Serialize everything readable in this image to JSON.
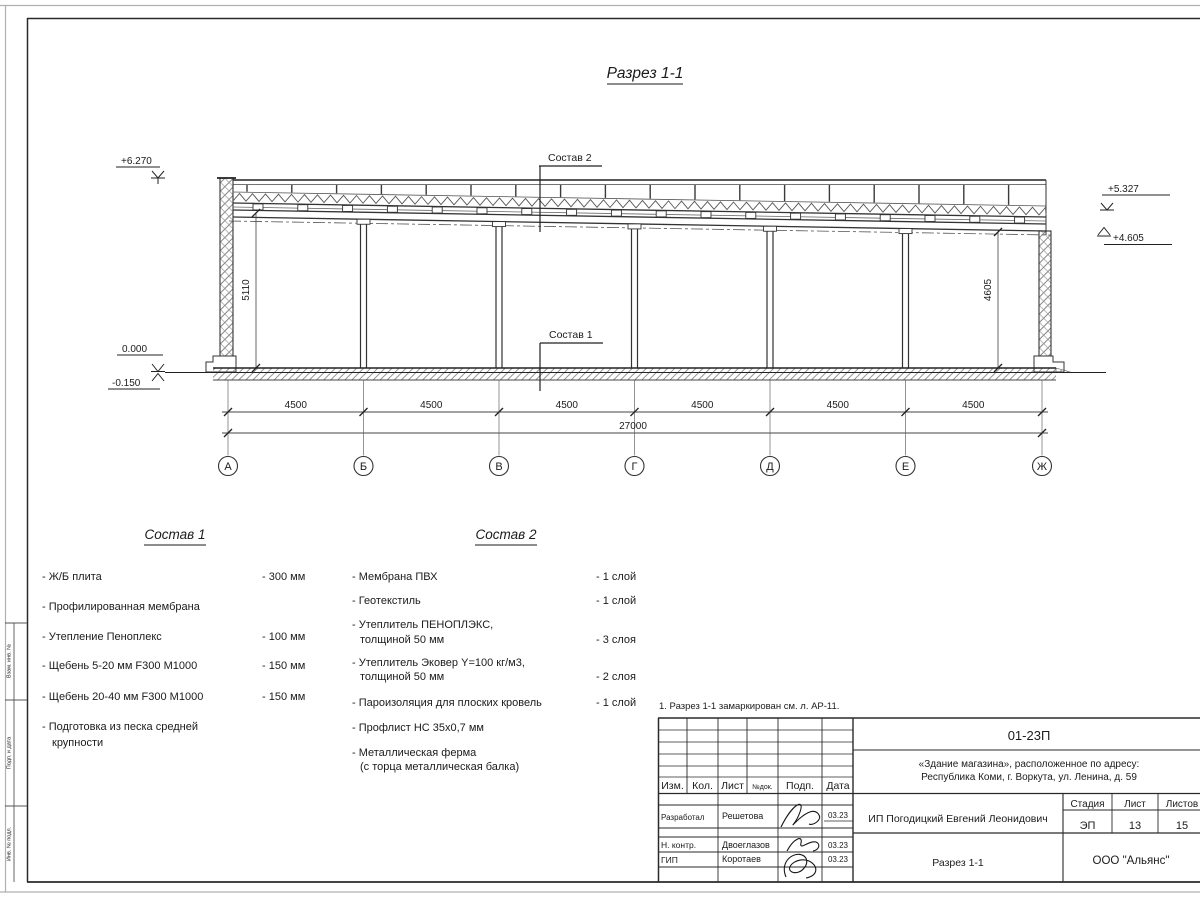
{
  "drawing": {
    "title": "Разрез 1-1",
    "callout_roof": "Состав 2",
    "callout_floor": "Состав 1",
    "elev_top_left": "+6.270",
    "elev_zero": "0.000",
    "elev_minus": "-0.150",
    "elev_right_upper": "+5.327",
    "elev_right_lower": "+4.605",
    "dim_height_left": "5110",
    "dim_height_right": "4605",
    "bay_dims": [
      "4500",
      "4500",
      "4500",
      "4500",
      "4500",
      "4500"
    ],
    "dim_total": "27000",
    "axes": [
      "А",
      "Б",
      "В",
      "Г",
      "Д",
      "Е",
      "Ж"
    ]
  },
  "sostav1": {
    "title": "Состав 1",
    "items": [
      {
        "name": "- Ж/Б плита",
        "value": "- 300 мм"
      },
      {
        "name": "- Профилированная мембрана",
        "value": ""
      },
      {
        "name": "- Утепление Пеноплекс",
        "value": "- 100 мм"
      },
      {
        "name": "-  Щебень 5-20 мм F300 М1000",
        "value": "- 150 мм"
      },
      {
        "name": "-  Щебень 20-40 мм F300 М1000",
        "value": "- 150 мм"
      },
      {
        "name": "- Подготовка из песка средней",
        "name2": "крупности",
        "value": ""
      }
    ]
  },
  "sostav2": {
    "title": "Состав 2",
    "items": [
      {
        "name": "- Мембрана ПВХ",
        "value": "- 1 слой"
      },
      {
        "name": "- Геотекстиль",
        "value": "- 1 слой"
      },
      {
        "name": "- Утеплитель ПЕНОПЛЭКС,",
        "name2": "толщиной 50 мм",
        "value": "- 3 слоя"
      },
      {
        "name": "- Утеплитель Эковер Y=100 кг/м3,",
        "name2": "толщиной 50 мм",
        "value": "- 2 слоя"
      },
      {
        "name": "- Пароизоляция для плоских кровель",
        "value": "- 1 слой"
      },
      {
        "name": "- Профлист НС 35х0,7 мм",
        "value": ""
      },
      {
        "name": "- Металлическая ферма",
        "name2": "(с торца металлическая балка)",
        "value": ""
      }
    ]
  },
  "note": "1. Разрез 1-1 замаркирован см. л. АР-11.",
  "margin": {
    "label_top": "Взам. инв. №",
    "label_mid": "Подп. и дата",
    "label_bottom": "Инв. № подл."
  },
  "titleblock": {
    "doc_number": "01-23П",
    "object_line1": "«Здание магазина», расположенное по адресу:",
    "object_line2": "Республика Коми, г. Воркута, ул. Ленина, д. 59",
    "cols": [
      "Изм.",
      "Кол.",
      "Лист",
      "№док.",
      "Подп.",
      "Дата"
    ],
    "row_developed_label": "Разработал",
    "row_developed_name": "Решетова",
    "row_developed_date": "03.23",
    "row_ncontrol_label": "Н. контр.",
    "row_ncontrol_name": "Двоеглазов",
    "row_ncontrol_date": "03.23",
    "row_gip_label": "ГИП",
    "row_gip_name": "Коротаев",
    "row_gip_date": "03.23",
    "client": "ИП Погодицкий Евгений Леонидович",
    "stage_label": "Стадия",
    "sheet_label": "Лист",
    "sheets_label": "Листов",
    "stage": "ЭП",
    "sheet_no": "13",
    "sheets_total": "15",
    "drawing_name": "Разрез 1-1",
    "company": "ООО \"Альянс\""
  }
}
